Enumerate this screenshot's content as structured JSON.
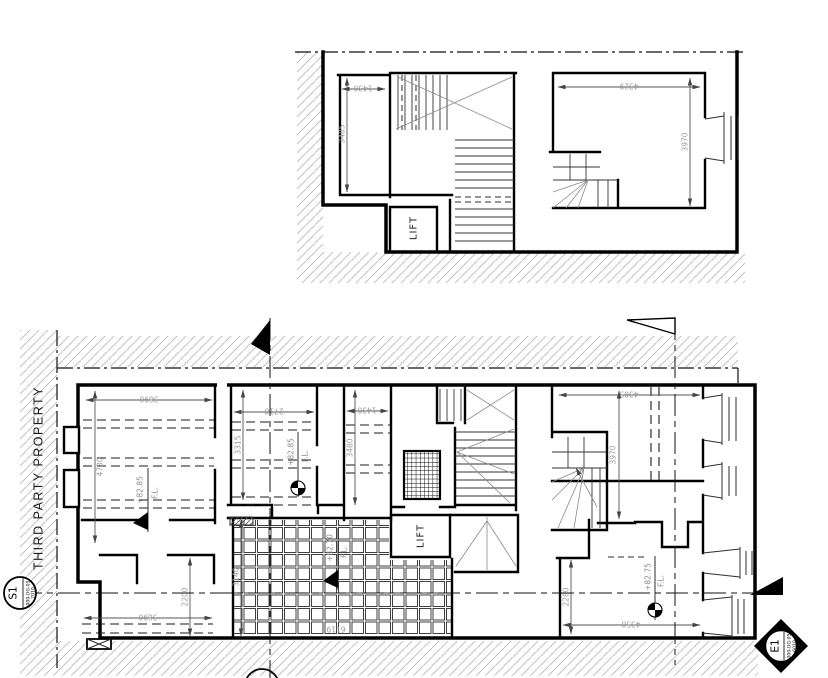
{
  "drawing": {
    "type": "architectural-floor-plan",
    "boundary_label": "THIRD PARTY PROPERTY",
    "section_markers": {
      "s1": {
        "label": "S1",
        "code": "000-DG-05",
        "sheet": "7010"
      },
      "e1": {
        "label": "E1",
        "code": "000-DG-05",
        "sheet": "6010"
      }
    },
    "upper_plan": {
      "lift_label": "LIFT",
      "dims": {
        "room_w": "1430",
        "room_h": "3485",
        "right_room_w": "4329",
        "right_room_h": "3970"
      }
    },
    "lower_plan": {
      "lift_label": "LIFT",
      "dims": {
        "room1_w": "3690",
        "room1_h": "4730",
        "room2_w": "2710",
        "room2_h": "3315",
        "room3_w": "1430",
        "room3_h": "3480",
        "right_room_w": "4305",
        "right_room_h": "3970",
        "lower_right_h": "2280",
        "lower_right_w": "4350",
        "lower_left_w": "3690",
        "lower_left_h": "2200",
        "court_h": "3140",
        "court_w": "6119"
      },
      "levels": {
        "fl_suffix": "F.L.",
        "room1": "+82.85",
        "room2": "+82.85",
        "lower_right": "+82.75",
        "courtyard": "+82.70"
      }
    },
    "colors": {
      "wall": "#000000",
      "dim_text": "#9b9b9b",
      "hatch": "#c2c2c2"
    }
  }
}
